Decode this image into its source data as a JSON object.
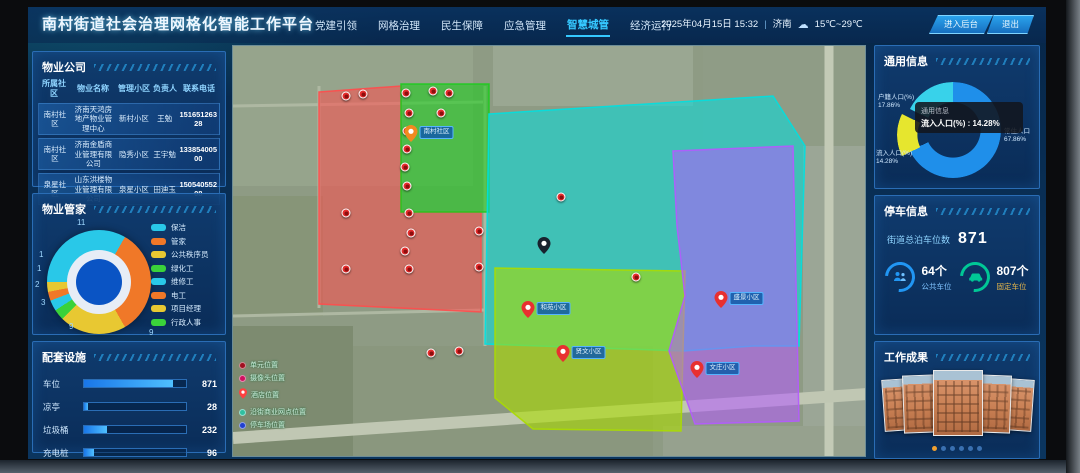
{
  "header": {
    "title": "南村街道社会治理网格化智能工作平台",
    "nav": [
      {
        "label": "党建引领",
        "active": false
      },
      {
        "label": "网格治理",
        "active": false
      },
      {
        "label": "民生保障",
        "active": false
      },
      {
        "label": "应急管理",
        "active": false
      },
      {
        "label": "智慧城管",
        "active": true
      },
      {
        "label": "经济运行",
        "active": false
      }
    ],
    "datetime": "2025年04月15日 15:32",
    "separator": "|",
    "city": "济南",
    "weather_icon": "cloud-icon",
    "temperature": "15℃~29℃",
    "buttons": [
      {
        "label": "进入后台"
      },
      {
        "label": "退出"
      }
    ]
  },
  "left": {
    "property_companies": {
      "title": "物业公司",
      "columns": [
        "所属社区",
        "物业名称",
        "管理小区",
        "负责人",
        "联系电话"
      ],
      "rows": [
        {
          "community": "南村社区",
          "company": "济南天鸿房地产物业管理中心",
          "estate": "新村小区",
          "manager": "王勉",
          "phone": "15165126328"
        },
        {
          "community": "南村社区",
          "company": "济南金盾商业管理有限公司",
          "estate": "隐秀小区",
          "manager": "王宇勉",
          "phone": "13385400500"
        },
        {
          "community": "泉星社区",
          "company": "山东洪楼物业管理有限公司",
          "estate": "泉星小区",
          "manager": "田迪玉",
          "phone": "15054055208"
        }
      ]
    },
    "stewards": {
      "title": "物业管家",
      "legend": [
        {
          "label": "保洁",
          "color": "#29c8e8",
          "value": 11
        },
        {
          "label": "管家",
          "color": "#f07828",
          "value": 9
        },
        {
          "label": "公共秩序员",
          "color": "#e8c832",
          "value": 9
        },
        {
          "label": "绿化工",
          "color": "#3ad23a",
          "value": 3
        },
        {
          "label": "维修工",
          "color": "#29c8e8",
          "value": 2
        },
        {
          "label": "电工",
          "color": "#f07828",
          "value": 1
        },
        {
          "label": "项目经理",
          "color": "#e8c832",
          "value": 1
        },
        {
          "label": "行政人事",
          "color": "#3ad23a",
          "value": 1
        }
      ],
      "callouts": [
        "11",
        "1",
        "1",
        "2",
        "3",
        "9",
        "9"
      ]
    },
    "facilities": {
      "title": "配套设施",
      "items": [
        {
          "label": "车位",
          "value": "871",
          "pct": 87
        },
        {
          "label": "凉亭",
          "value": "28",
          "pct": 4
        },
        {
          "label": "垃圾桶",
          "value": "232",
          "pct": 23
        },
        {
          "label": "充电桩",
          "value": "96",
          "pct": 10
        }
      ]
    }
  },
  "map": {
    "zones": [
      {
        "id": "red",
        "color": "#ff4d4d"
      },
      {
        "id": "green",
        "color": "#1ecb1e"
      },
      {
        "id": "cyan",
        "color": "#00e0e0"
      },
      {
        "id": "yellowgreen",
        "color": "#aadc00"
      },
      {
        "id": "purple",
        "color": "#b45aff"
      }
    ],
    "community_pin": {
      "x": 196,
      "y": 96,
      "label": "南村社区"
    },
    "center_pin": {
      "x": 311,
      "y": 208
    },
    "labeled_markers": [
      {
        "x": 313,
        "y": 272,
        "label": "和苑小区"
      },
      {
        "x": 506,
        "y": 262,
        "label": "盛景小区"
      },
      {
        "x": 482,
        "y": 332,
        "label": "文庄小区"
      },
      {
        "x": 348,
        "y": 316,
        "label": "贤文小区"
      }
    ],
    "markers": [
      [
        113,
        50
      ],
      [
        130,
        48
      ],
      [
        173,
        47
      ],
      [
        200,
        45
      ],
      [
        216,
        47
      ],
      [
        176,
        67
      ],
      [
        208,
        67
      ],
      [
        174,
        85
      ],
      [
        174,
        103
      ],
      [
        172,
        121
      ],
      [
        174,
        140
      ],
      [
        113,
        167
      ],
      [
        176,
        167
      ],
      [
        178,
        187
      ],
      [
        246,
        185
      ],
      [
        172,
        205
      ],
      [
        113,
        223
      ],
      [
        176,
        223
      ],
      [
        246,
        221
      ],
      [
        328,
        151
      ],
      [
        403,
        231
      ],
      [
        198,
        307
      ],
      [
        226,
        305
      ]
    ],
    "legend": [
      {
        "label": "单元位置",
        "color": "#a01020"
      },
      {
        "label": "摄像头位置",
        "color": "#d01060"
      },
      {
        "label": "酒店位置",
        "color": "#ff4040"
      },
      {
        "label": "沿街商业网点位置",
        "color": "#30c0a0"
      },
      {
        "label": "停车场位置",
        "color": "#2040d0"
      }
    ]
  },
  "right": {
    "general_info": {
      "title": "通用信息",
      "slices": [
        {
          "label": "常住人口",
          "pct": "67.86%",
          "color": "#1f8fea"
        },
        {
          "label": "户籍人口(%)",
          "pct": "17.86%",
          "color": "#38d2ea"
        },
        {
          "label": "流入人口(%)",
          "pct": "14.28%",
          "color": "#e6e62e"
        }
      ],
      "tooltip": {
        "line1": "通用信息",
        "line2": "流入人口(%) : 14.28%"
      }
    },
    "parking": {
      "title": "停车信息",
      "total_label": "街道总泊车位数",
      "total_value": "871",
      "stats": [
        {
          "value": "64个",
          "label": "公共车位",
          "color": "#2196f3",
          "icon": "people-icon"
        },
        {
          "value": "807个",
          "label": "固定车位",
          "color": "#00c896",
          "icon": "car-icon",
          "label_color": "#e8b84a"
        }
      ]
    },
    "results": {
      "title": "工作成果",
      "photo_count": 5,
      "dots": 6,
      "active_dot": 0
    }
  },
  "chart_data": [
    {
      "type": "pie",
      "title": "物业管家",
      "categories": [
        "保洁",
        "管家",
        "公共秩序员",
        "绿化工",
        "维修工",
        "电工",
        "项目经理",
        "行政人事"
      ],
      "values": [
        11,
        9,
        9,
        3,
        2,
        1,
        1,
        1
      ],
      "legend_position": "right"
    },
    {
      "type": "pie",
      "title": "通用信息",
      "categories": [
        "常住人口",
        "户籍人口(%)",
        "流入人口(%)"
      ],
      "values": [
        67.86,
        17.86,
        14.28
      ],
      "unit": "%"
    },
    {
      "type": "bar",
      "title": "配套设施",
      "categories": [
        "车位",
        "凉亭",
        "垃圾桶",
        "充电桩"
      ],
      "values": [
        871,
        28,
        232,
        96
      ],
      "xlim": [
        0,
        1000
      ]
    }
  ]
}
